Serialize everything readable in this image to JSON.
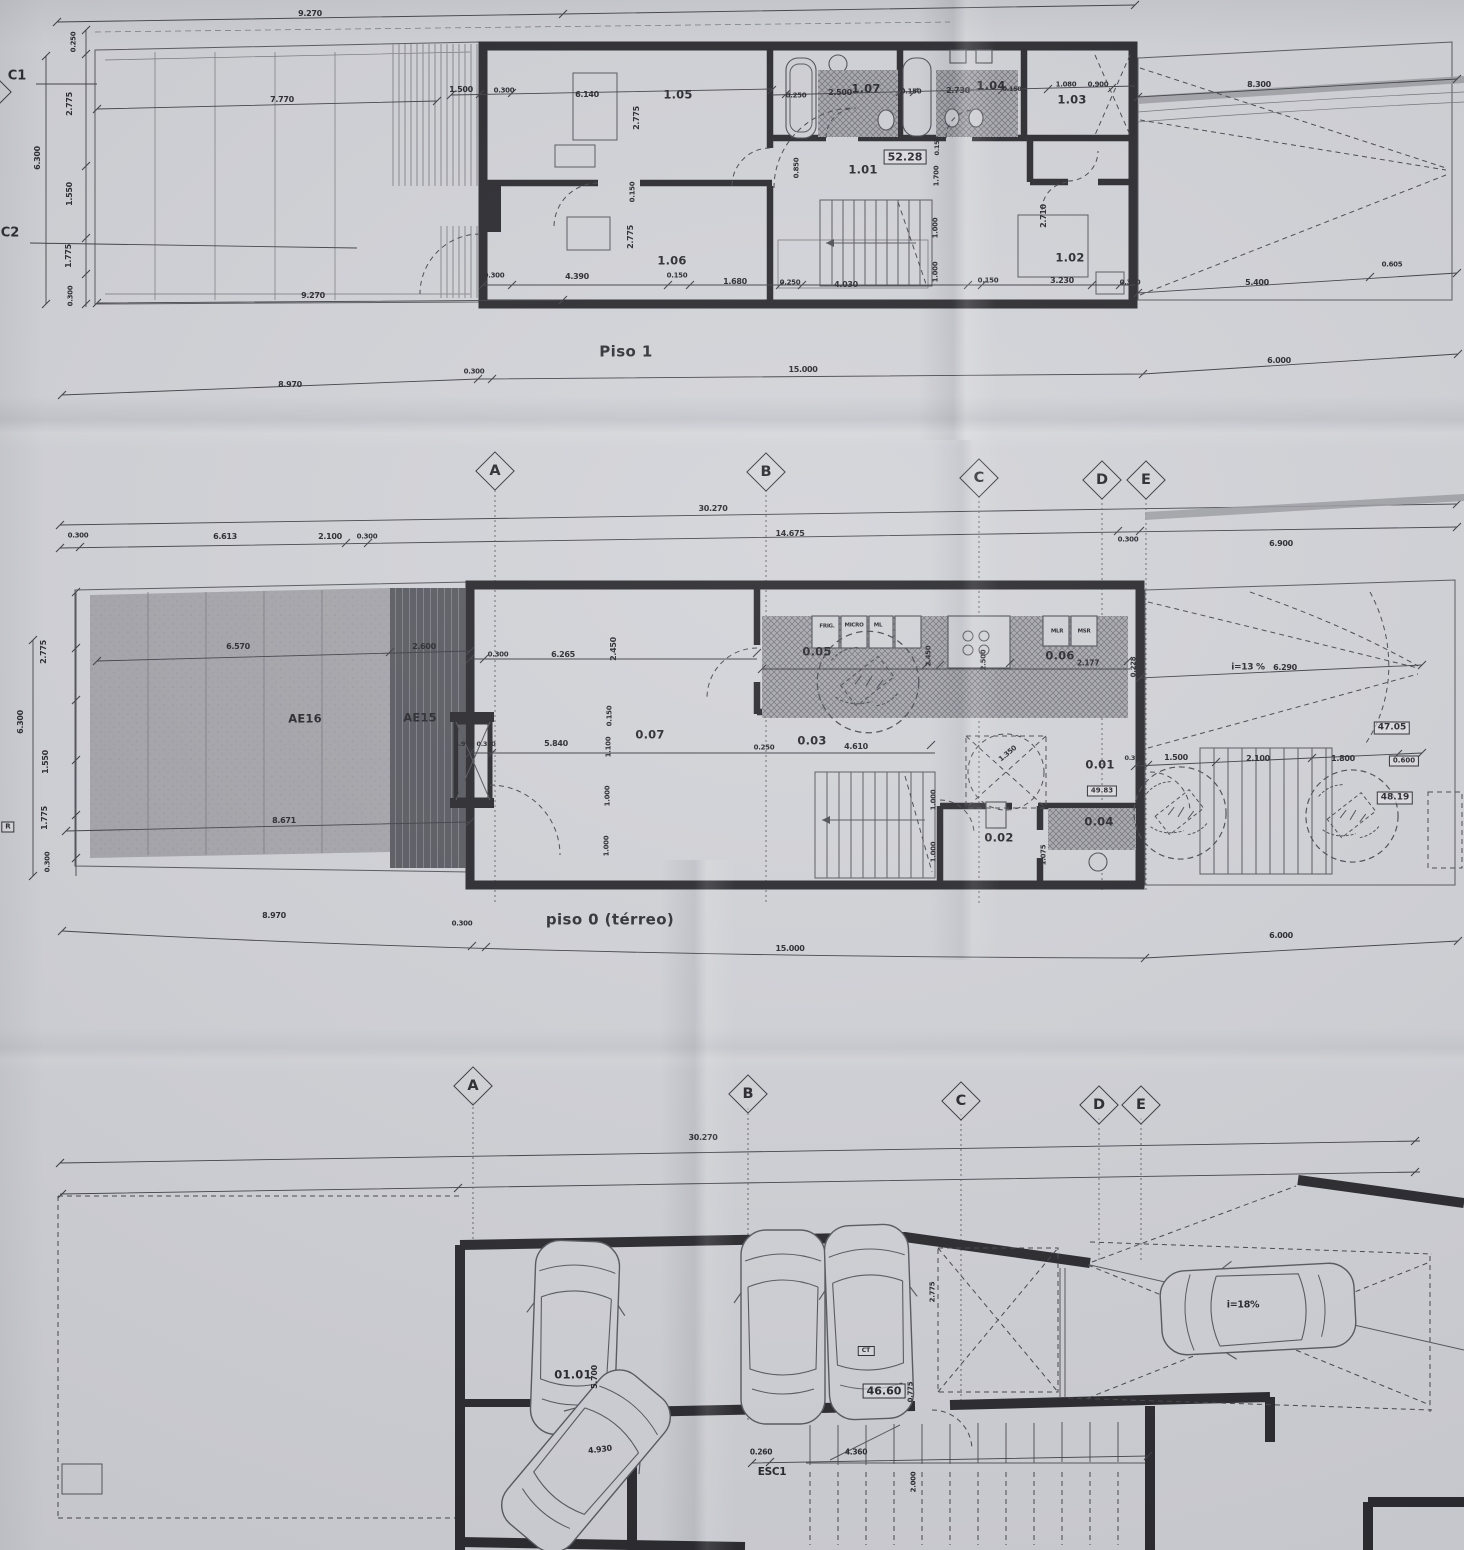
{
  "captions": {
    "piso1": "Piso 1",
    "piso0": "piso 0 (térreo)"
  },
  "grid_markers": [
    {
      "t": "",
      "x": -8,
      "y": 92,
      "c": "gmark"
    },
    {
      "t": "A",
      "x": 495,
      "y": 471,
      "c": "gmark"
    },
    {
      "t": "B",
      "x": 766,
      "y": 472,
      "c": "gmark"
    },
    {
      "t": "C",
      "x": 979,
      "y": 478,
      "c": "gmark"
    },
    {
      "t": "D",
      "x": 1102,
      "y": 480,
      "c": "gmark"
    },
    {
      "t": "E",
      "x": 1146,
      "y": 480,
      "c": "gmark"
    },
    {
      "t": "A",
      "x": 473,
      "y": 1086,
      "c": "gmark"
    },
    {
      "t": "B",
      "x": 748,
      "y": 1094,
      "c": "gmark"
    },
    {
      "t": "C",
      "x": 961,
      "y": 1101,
      "c": "gmark"
    },
    {
      "t": "D",
      "x": 1099,
      "y": 1105,
      "c": "gmark"
    },
    {
      "t": "E",
      "x": 1141,
      "y": 1105,
      "c": "gmark"
    }
  ],
  "labels": {
    "piso1": [
      {
        "t": "C1",
        "x": 17,
        "y": 76,
        "c": "axis"
      },
      {
        "t": "C2",
        "x": 10,
        "y": 233,
        "c": "axis"
      },
      {
        "t": "9.270",
        "x": 310,
        "y": 14
      },
      {
        "t": "7.770",
        "x": 282,
        "y": 100
      },
      {
        "t": "0.250",
        "x": 74,
        "y": 42,
        "r": -90,
        "s": 7
      },
      {
        "t": "2.775",
        "x": 70,
        "y": 104,
        "r": -90
      },
      {
        "t": "6.300",
        "x": 38,
        "y": 158,
        "r": -90
      },
      {
        "t": "1.550",
        "x": 70,
        "y": 194,
        "r": -90
      },
      {
        "t": "1.775",
        "x": 69,
        "y": 256,
        "r": -90
      },
      {
        "t": "0.300",
        "x": 71,
        "y": 296,
        "r": -90,
        "s": 7
      },
      {
        "t": "1.500",
        "x": 461,
        "y": 90
      },
      {
        "t": "0.300",
        "x": 504,
        "y": 91,
        "s": 7
      },
      {
        "t": "6.140",
        "x": 587,
        "y": 95
      },
      {
        "t": "2.775",
        "x": 637,
        "y": 118,
        "r": -90
      },
      {
        "t": "0.150",
        "x": 633,
        "y": 192,
        "r": -90,
        "s": 7
      },
      {
        "t": "2.775",
        "x": 631,
        "y": 237,
        "r": -90
      },
      {
        "t": "1.05",
        "x": 678,
        "y": 95,
        "c": "room"
      },
      {
        "t": "1.06",
        "x": 672,
        "y": 261,
        "c": "room"
      },
      {
        "t": "0.250",
        "x": 796,
        "y": 96,
        "s": 7
      },
      {
        "t": "2.500",
        "x": 840,
        "y": 93
      },
      {
        "t": "1.07",
        "x": 866,
        "y": 89,
        "c": "room"
      },
      {
        "t": "0.150",
        "x": 911,
        "y": 92,
        "s": 7
      },
      {
        "t": "2.730",
        "x": 958,
        "y": 91
      },
      {
        "t": "1.04",
        "x": 991,
        "y": 86,
        "c": "room"
      },
      {
        "t": "0.150",
        "x": 1012,
        "y": 89,
        "s": 6.5
      },
      {
        "t": "1.080",
        "x": 1066,
        "y": 85,
        "s": 7
      },
      {
        "t": "0.900",
        "x": 1098,
        "y": 85,
        "s": 7
      },
      {
        "t": "1.03",
        "x": 1072,
        "y": 100,
        "c": "room"
      },
      {
        "t": "8.300",
        "x": 1259,
        "y": 85
      },
      {
        "t": "52.28",
        "x": 905,
        "y": 157,
        "c": "badge",
        "s": 11
      },
      {
        "t": "1.01",
        "x": 863,
        "y": 170,
        "c": "room"
      },
      {
        "t": "0.850",
        "x": 797,
        "y": 168,
        "r": -90,
        "s": 7
      },
      {
        "t": "0.150",
        "x": 937,
        "y": 146,
        "r": -90,
        "s": 6.5
      },
      {
        "t": "1.700",
        "x": 937,
        "y": 176,
        "r": -90,
        "s": 7
      },
      {
        "t": "1.000",
        "x": 936,
        "y": 228,
        "r": -90,
        "s": 7
      },
      {
        "t": "1.000",
        "x": 936,
        "y": 272,
        "r": -90,
        "s": 7
      },
      {
        "t": "2.710",
        "x": 1044,
        "y": 216,
        "r": -90
      },
      {
        "t": "1.02",
        "x": 1070,
        "y": 258,
        "c": "room"
      },
      {
        "t": "9.270",
        "x": 313,
        "y": 296
      },
      {
        "t": "0.300",
        "x": 494,
        "y": 276,
        "s": 7
      },
      {
        "t": "4.390",
        "x": 577,
        "y": 277
      },
      {
        "t": "0.150",
        "x": 677,
        "y": 276,
        "s": 7
      },
      {
        "t": "1.680",
        "x": 735,
        "y": 282
      },
      {
        "t": "0.250",
        "x": 790,
        "y": 283,
        "s": 7
      },
      {
        "t": "4.030",
        "x": 846,
        "y": 285
      },
      {
        "t": "0.150",
        "x": 988,
        "y": 281,
        "s": 7
      },
      {
        "t": "3.230",
        "x": 1062,
        "y": 281
      },
      {
        "t": "0.300",
        "x": 1130,
        "y": 283,
        "s": 7
      },
      {
        "t": "5.400",
        "x": 1257,
        "y": 283
      },
      {
        "t": "0.605",
        "x": 1392,
        "y": 265,
        "s": 7
      },
      {
        "t": "8.970",
        "x": 290,
        "y": 385
      },
      {
        "t": "0.300",
        "x": 474,
        "y": 372,
        "s": 7
      },
      {
        "t": "15.000",
        "x": 803,
        "y": 370
      },
      {
        "t": "6.000",
        "x": 1279,
        "y": 361
      }
    ],
    "piso0": [
      {
        "t": "30.270",
        "x": 713,
        "y": 509
      },
      {
        "t": "0.300",
        "x": 78,
        "y": 536,
        "s": 7
      },
      {
        "t": "6.613",
        "x": 225,
        "y": 537
      },
      {
        "t": "2.100",
        "x": 330,
        "y": 537
      },
      {
        "t": "0.300",
        "x": 367,
        "y": 537,
        "s": 7
      },
      {
        "t": "14.675",
        "x": 790,
        "y": 534
      },
      {
        "t": "0.300",
        "x": 1128,
        "y": 540,
        "s": 7
      },
      {
        "t": "6.900",
        "x": 1281,
        "y": 544
      },
      {
        "t": "2.775",
        "x": 44,
        "y": 652,
        "r": -90
      },
      {
        "t": "6.300",
        "x": 21,
        "y": 722,
        "r": -90
      },
      {
        "t": "1.550",
        "x": 46,
        "y": 762,
        "r": -90
      },
      {
        "t": "1.775",
        "x": 45,
        "y": 818,
        "r": -90
      },
      {
        "t": "0.300",
        "x": 48,
        "y": 862,
        "r": -90,
        "s": 7
      },
      {
        "t": "R",
        "x": 8,
        "y": 827,
        "c": "badge",
        "s": 7
      },
      {
        "t": "6.570",
        "x": 238,
        "y": 647
      },
      {
        "t": "2.600",
        "x": 424,
        "y": 647
      },
      {
        "t": "AE16",
        "x": 305,
        "y": 719,
        "c": "room"
      },
      {
        "t": "AE15",
        "x": 420,
        "y": 718,
        "c": "room"
      },
      {
        "t": "8.671",
        "x": 284,
        "y": 821
      },
      {
        "t": "4.970",
        "x": 464,
        "y": 744,
        "s": 6.5
      },
      {
        "t": "0.300",
        "x": 486,
        "y": 744,
        "s": 6.5
      },
      {
        "t": "0.300",
        "x": 498,
        "y": 655,
        "s": 7
      },
      {
        "t": "6.265",
        "x": 563,
        "y": 655
      },
      {
        "t": "2.450",
        "x": 614,
        "y": 649,
        "r": -90
      },
      {
        "t": "0.150",
        "x": 610,
        "y": 716,
        "r": -90,
        "s": 7
      },
      {
        "t": "1.100",
        "x": 609,
        "y": 747,
        "r": -90,
        "s": 7
      },
      {
        "t": "5.840",
        "x": 556,
        "y": 744
      },
      {
        "t": "0.07",
        "x": 650,
        "y": 735,
        "c": "room"
      },
      {
        "t": "1.000",
        "x": 608,
        "y": 796,
        "r": -90,
        "s": 7
      },
      {
        "t": "1.000",
        "x": 607,
        "y": 846,
        "r": -90,
        "s": 7
      },
      {
        "t": "0.250",
        "x": 764,
        "y": 748,
        "s": 7
      },
      {
        "t": "0.03",
        "x": 812,
        "y": 741,
        "c": "room"
      },
      {
        "t": "4.610",
        "x": 856,
        "y": 747
      },
      {
        "t": "1.000",
        "x": 934,
        "y": 800,
        "r": -90,
        "s": 7
      },
      {
        "t": "1.000",
        "x": 934,
        "y": 852,
        "r": -90,
        "s": 7
      },
      {
        "t": "0.05",
        "x": 817,
        "y": 652,
        "c": "room"
      },
      {
        "t": "FRIG.",
        "x": 827,
        "y": 627,
        "s": 5.5
      },
      {
        "t": "MICRO",
        "x": 854,
        "y": 626,
        "s": 5.5
      },
      {
        "t": "ML",
        "x": 878,
        "y": 626,
        "s": 5.5
      },
      {
        "t": "2.450",
        "x": 929,
        "y": 656,
        "r": -90,
        "s": 7
      },
      {
        "t": "2.500",
        "x": 984,
        "y": 660,
        "r": -90,
        "s": 7
      },
      {
        "t": "0.06",
        "x": 1060,
        "y": 656,
        "c": "room"
      },
      {
        "t": "MLR",
        "x": 1057,
        "y": 632,
        "s": 5.5
      },
      {
        "t": "MSR",
        "x": 1084,
        "y": 632,
        "s": 5.5
      },
      {
        "t": "2.177",
        "x": 1088,
        "y": 663,
        "s": 7.5
      },
      {
        "t": "0.228",
        "x": 1134,
        "y": 667,
        "r": -90,
        "s": 7
      },
      {
        "t": "i=13 %",
        "x": 1248,
        "y": 668,
        "s": 9
      },
      {
        "t": "6.290",
        "x": 1285,
        "y": 668
      },
      {
        "t": "47.05",
        "x": 1392,
        "y": 728,
        "c": "badge"
      },
      {
        "t": "0.300",
        "x": 1134,
        "y": 758,
        "s": 6.5
      },
      {
        "t": "1.500",
        "x": 1176,
        "y": 758
      },
      {
        "t": "2.100",
        "x": 1258,
        "y": 759
      },
      {
        "t": "1.800",
        "x": 1343,
        "y": 759
      },
      {
        "t": "0.600",
        "x": 1404,
        "y": 761,
        "c": "badge",
        "s": 7
      },
      {
        "t": "48.19",
        "x": 1395,
        "y": 798,
        "c": "badge"
      },
      {
        "t": "0.01",
        "x": 1100,
        "y": 765,
        "c": "room"
      },
      {
        "t": "49.83",
        "x": 1102,
        "y": 791,
        "c": "badge",
        "s": 7
      },
      {
        "t": "1.350",
        "x": 1008,
        "y": 754,
        "r": -40,
        "s": 7
      },
      {
        "t": "0.02",
        "x": 999,
        "y": 838,
        "c": "room"
      },
      {
        "t": "0.04",
        "x": 1099,
        "y": 822,
        "c": "room"
      },
      {
        "t": "1.075",
        "x": 1044,
        "y": 855,
        "r": -90,
        "s": 7
      },
      {
        "t": "8.970",
        "x": 274,
        "y": 916
      },
      {
        "t": "0.300",
        "x": 462,
        "y": 924,
        "s": 7
      },
      {
        "t": "15.000",
        "x": 790,
        "y": 949
      },
      {
        "t": "6.000",
        "x": 1281,
        "y": 936
      }
    ],
    "garagem": [
      {
        "t": "30.270",
        "x": 703,
        "y": 1138
      },
      {
        "t": "01.01",
        "x": 573,
        "y": 1375,
        "c": "room"
      },
      {
        "t": "5.700",
        "x": 595,
        "y": 1377,
        "r": -90
      },
      {
        "t": "4.930",
        "x": 600,
        "y": 1450,
        "r": -7
      },
      {
        "t": "2.775",
        "x": 933,
        "y": 1292,
        "r": -90,
        "s": 7
      },
      {
        "t": "CT",
        "x": 866,
        "y": 1351,
        "c": "badge",
        "s": 6
      },
      {
        "t": "46.60",
        "x": 884,
        "y": 1391,
        "c": "badge",
        "s": 11
      },
      {
        "t": "0.775",
        "x": 911,
        "y": 1392,
        "r": -90,
        "s": 7
      },
      {
        "t": "ESC1",
        "x": 772,
        "y": 1472,
        "s": 10.5
      },
      {
        "t": "0.260",
        "x": 761,
        "y": 1452,
        "s": 7.5
      },
      {
        "t": "4.360",
        "x": 856,
        "y": 1452,
        "s": 7.5
      },
      {
        "t": "2.000",
        "x": 914,
        "y": 1482,
        "r": -90,
        "s": 7
      },
      {
        "t": "i=18%",
        "x": 1243,
        "y": 1305,
        "s": 9.5
      }
    ]
  }
}
